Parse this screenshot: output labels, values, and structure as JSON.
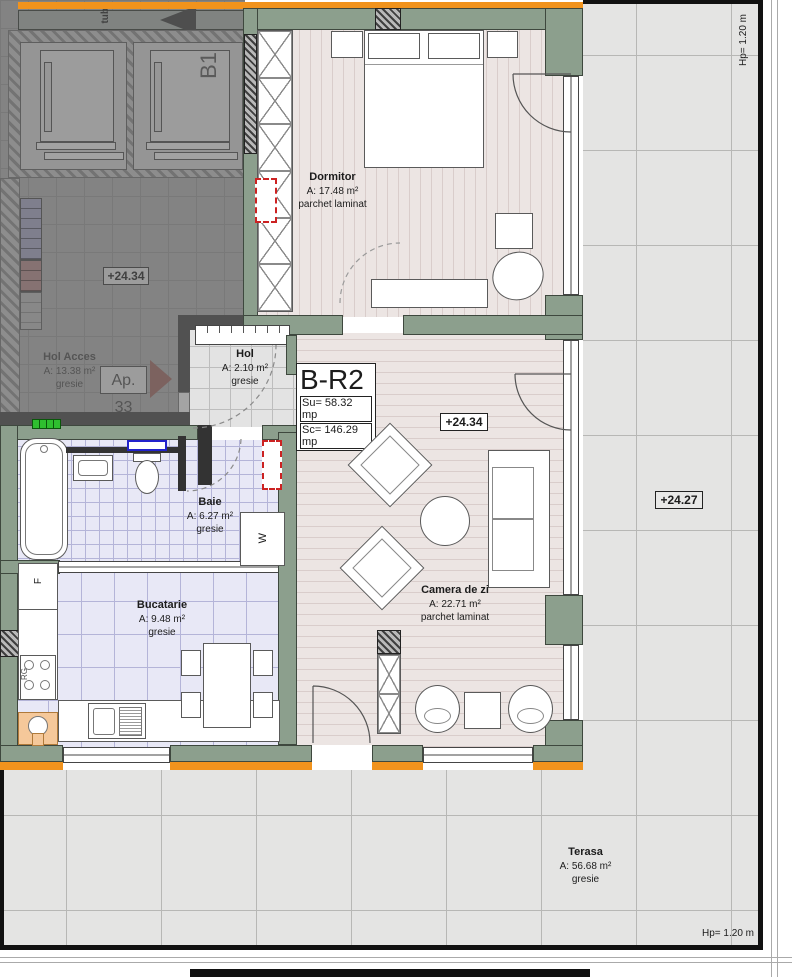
{
  "labels": {
    "unit": "B-R2",
    "su": "Su= 58.32 mp",
    "sc": "Sc= 146.29 mp",
    "level_living": "+24.34",
    "level_access": "+24.34",
    "level_terrace": "+24.27",
    "parapet_right": "Hp= 1.20 m",
    "parapet_bottom": "Hp= 1.20 m",
    "apartment_ref": "Ap. 33",
    "elevator": "B1",
    "duct": "tub",
    "fridge": "F",
    "range": "RG",
    "washer": "W"
  },
  "rooms": [
    {
      "id": "dormitor",
      "name": "Dormitor",
      "area": "A: 17.48 m²",
      "finish": "parchet laminat"
    },
    {
      "id": "hol",
      "name": "Hol",
      "area": "A: 2.10 m²",
      "finish": "gresie"
    },
    {
      "id": "baie",
      "name": "Baie",
      "area": "A: 6.27 m²",
      "finish": "gresie"
    },
    {
      "id": "bucatarie",
      "name": "Bucatarie",
      "area": "A: 9.48 m²",
      "finish": "gresie"
    },
    {
      "id": "camera_de_zi",
      "name": "Camera de zi",
      "area": "A: 22.71 m²",
      "finish": "parchet laminat"
    },
    {
      "id": "terasa",
      "name": "Terasa",
      "area": "A: 56.68 m²",
      "finish": "gresie"
    },
    {
      "id": "hol_acces",
      "name": "Hol Acces",
      "area": "A: 13.38 m²",
      "finish": "gresie"
    }
  ],
  "colors": {
    "wall_green": "#8c9f8d",
    "accent_orange": "#f1931d",
    "terrace_tile": "#e4e4e3",
    "bath_tile": "#e8e8f6",
    "wood_floor": "#ece5e3",
    "stairs_blue": "#9b9bd1",
    "stairs_red": "#cc7d7d",
    "marker_green": "#2fbf2f",
    "arrow_salmon": "#c26055",
    "radiator_red": "#cc2222",
    "window_blue": "#2222cc"
  }
}
